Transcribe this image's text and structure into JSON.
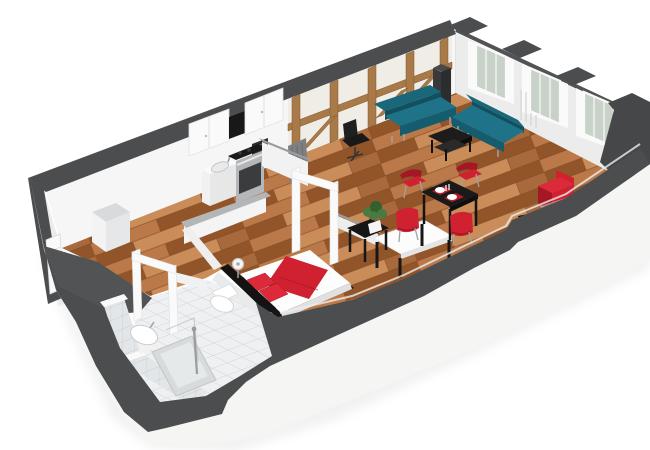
{
  "meta": {
    "kind": "3d-floor-plan-render",
    "view": "cutaway isometric perspective, apartment seen from above",
    "background": "#ffffff"
  },
  "colors": {
    "wall_top": "#4b4d4f",
    "wall_face": "#f6f6f6",
    "wall_face_shade": "#ececec",
    "interior_dark": "#454749",
    "exterior_white": "#f5f5f4",
    "plaster": "#f0ece6",
    "wood_base": "#a8693c",
    "wood_light": "#bb7848",
    "wood_lighter": "#ca8d59",
    "wood_dark": "#92552a",
    "wood_seam": "#7c4824",
    "tile_base": "#eef0f1",
    "tile_line": "#c9ced2",
    "tile_wall": "#e3e6e8",
    "timber": "#a87a48",
    "timber_dark": "#84572e",
    "teal": "#1e7389",
    "teal_dark": "#155c6e",
    "teal_deep": "#12505f",
    "teal_back": "#1a677a",
    "red": "#cf2130",
    "red_dark": "#a31824",
    "red_bright": "#dd2a3a",
    "black": "#161616",
    "steel": "#b4b7b9",
    "steel_dark": "#5a5d5f",
    "glass": "#c9d2c8",
    "frame_white": "#fafafa",
    "chrome": "#9fa2a4",
    "radiator": "#7e8082",
    "shower": "#d8dbdc",
    "plant": "#4a7a40",
    "plant_dark": "#33602f",
    "gray_top_light": "#b3b5b6",
    "gray_top_mid": "#9b9d9f",
    "shadow": "#cfcfcf"
  },
  "scene": {
    "architecture": {
      "walls": "white plaster exterior walls cut away, cut tops rendered dark gray",
      "feature_wall": "timber-framed (fachwerk) wall with exposed wood posts, rail and braces",
      "window_bays": 3,
      "door_frames": [
        "bathroom-door-frame",
        "bedroom-door-frame"
      ],
      "entry_door": "white panel door on left wall"
    },
    "rooms": [
      {
        "name": "living-dining-room",
        "floor": "wood-parquet",
        "furniture": [
          "teal-sofa-left",
          "teal-sofa-right",
          "black-coffee-table",
          "black-office-chair",
          "black-dining-table",
          "red-dining-chairs-x4",
          "two-place-settings",
          "red-chair-at-front-wall",
          "dark-column-heater",
          "wall-radiator",
          "remote-on-floor"
        ]
      },
      {
        "name": "kitchen",
        "floor": "wood-parquet",
        "furniture": [
          "white-upper-cabinets",
          "range-hood",
          "microwave",
          "sink-cabinet",
          "steel-stove-oven"
        ]
      },
      {
        "name": "bedroom",
        "floor": "wood-parquet",
        "furniture": [
          "double-bed-white-red",
          "black-headboard",
          "table-fan",
          "white-top-desk",
          "black-side-table",
          "green-plant"
        ]
      },
      {
        "name": "bathroom",
        "floor": "white-tile",
        "furniture": [
          "toilet",
          "pedestal-sink",
          "shower-tray",
          "shower-column"
        ]
      },
      {
        "name": "hallway-entry",
        "floor": "wood-parquet",
        "furniture": [
          "white-closet"
        ]
      }
    ]
  }
}
